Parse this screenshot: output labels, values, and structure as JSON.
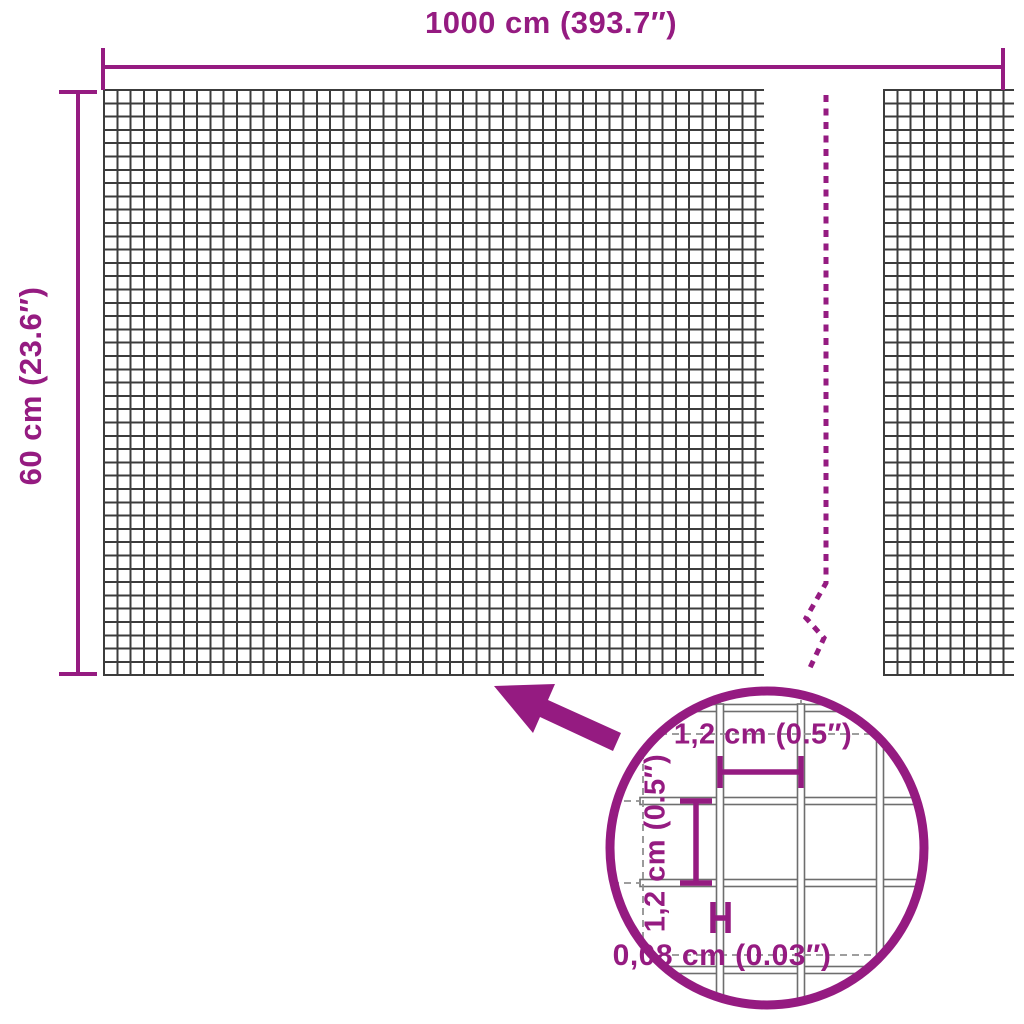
{
  "colors": {
    "accent": "#951B81",
    "mesh": "#3C3C3C",
    "detail_wire": "#6E6E6E",
    "dashed_gray": "#909090",
    "background": "#FFFFFF"
  },
  "labels": {
    "total_width": "1000 cm (393.7″)",
    "total_height": "60 cm (23.6″)",
    "mesh_opening_width": "1,2 cm (0.5″)",
    "mesh_opening_height": "1,2 cm (0.5″)",
    "wire_thickness": "0,08 cm (0.03″)"
  }
}
